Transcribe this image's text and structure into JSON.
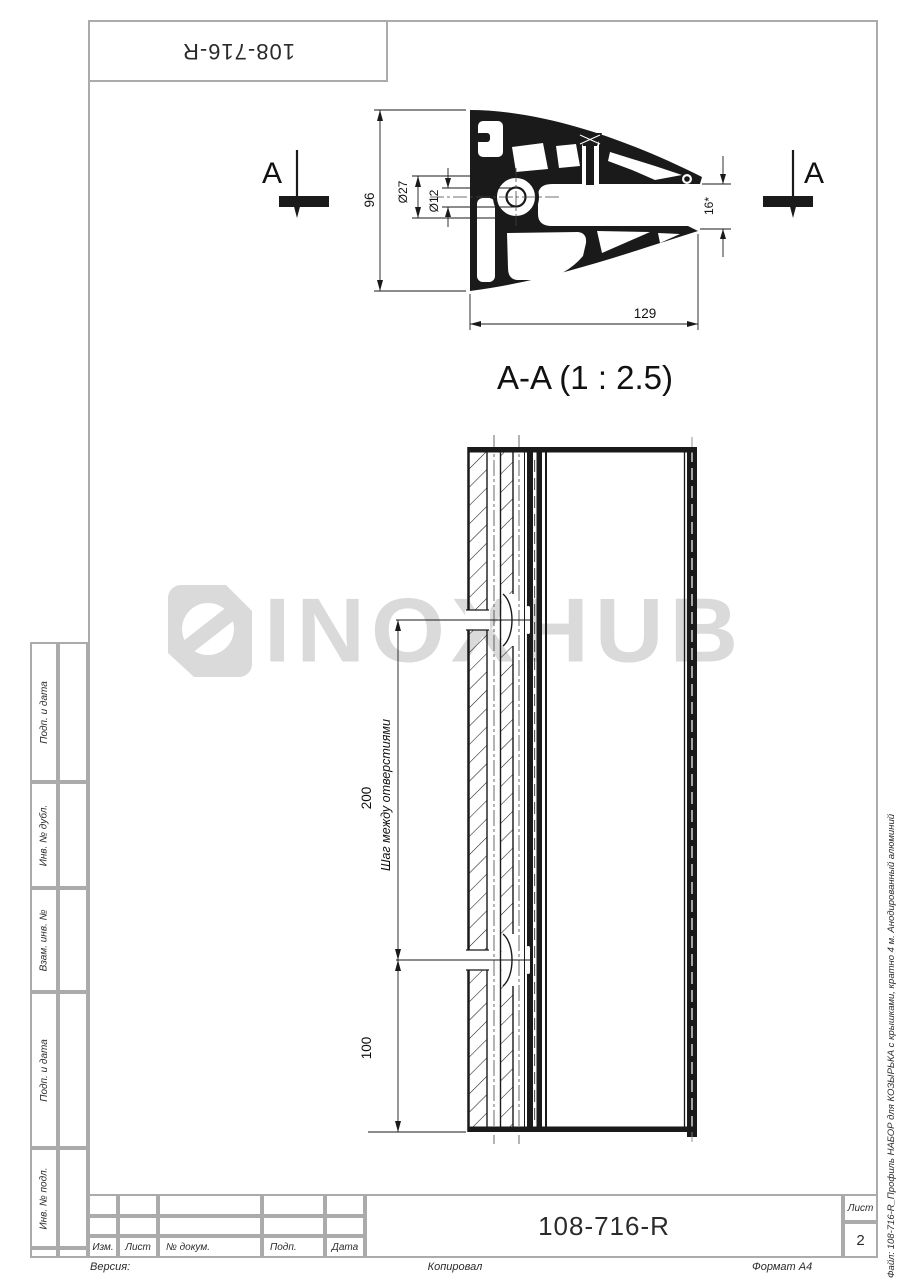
{
  "drawing": {
    "top_stamp": "108-716-R",
    "section_letter": "A",
    "section_label": "A-A (1 : 2.5)",
    "dims": {
      "height": "96",
      "boss_outer": "Ø27",
      "boss_inner": "Ø12",
      "width": "129",
      "slot": "16*",
      "hole_step": "200",
      "hole_step_label": "Шаг между отверстиями",
      "hole_end": "100"
    }
  },
  "watermark": {
    "text": "INOXHUB",
    "color": "#dadada"
  },
  "sidebar": {
    "labels": [
      "Подп. и дата",
      "Инв. № дубл.",
      "Взам. инв. №",
      "Подп. и дата",
      "Инв. № подл."
    ]
  },
  "title_block": {
    "columns": [
      "Изм.",
      "Лист",
      "№ докум.",
      "Подп.",
      "Дата"
    ],
    "designation": "108-716-R",
    "sheet_label": "Лист",
    "sheet_number": "2"
  },
  "margin": {
    "version": "Версия:",
    "copied": "Копировал",
    "format": "Формат A4",
    "file_info": "Файл: 108-716-R_Профиль НАБОР для КОЗЫРЬКА с крышками, кратно 4 м. Анодированный алюминий"
  },
  "colors": {
    "line": "#1a1a1a",
    "frame": "#ababab",
    "watermark": "#dadada"
  }
}
